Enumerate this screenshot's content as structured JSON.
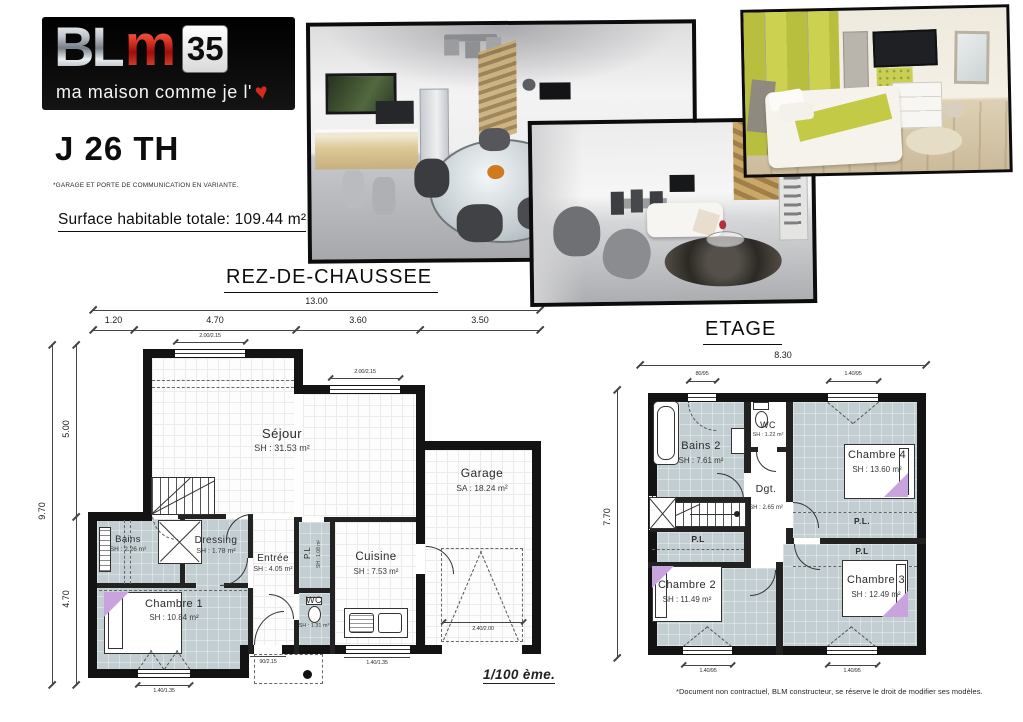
{
  "logo": {
    "bl": "BL",
    "m": "m",
    "number": "35",
    "tagline": "ma maison comme je l'",
    "heart": "♥"
  },
  "header": {
    "model": "J 26 TH",
    "variant_note": "*GARAGE ET PORTE DE COMMUNICATION EN VARIANTE.",
    "surface_total": "Surface habitable totale: 109.44 m²"
  },
  "rdc": {
    "title": "REZ-DE-CHAUSSEE",
    "dims": {
      "total_width": "13.00",
      "seg_1": "1.20",
      "seg_2": "4.70",
      "seg_3": "3.60",
      "seg_4": "3.50",
      "total_height": "9.70",
      "hseg_1": "5.00",
      "hseg_2": "4.70",
      "win_sejour_left": "2.00/2.15",
      "win_sejour_right": "2.00/2.15",
      "win_chambre": "1.40/1.35",
      "door_entree": "90/2.15",
      "win_cuisine": "1.40/1.35",
      "door_garage": "2.40/2.00"
    },
    "rooms": {
      "sejour": {
        "name": "Séjour",
        "area": "SH : 31.53 m²"
      },
      "garage": {
        "name": "Garage",
        "area": "SA : 18.24 m²"
      },
      "bains": {
        "name": "Bains",
        "area": "SH : 2.26 m²"
      },
      "dressing": {
        "name": "Dressing",
        "area": "SH : 1.78 m²"
      },
      "entree": {
        "name": "Entrée",
        "area": "SH : 4.05 m²"
      },
      "placard": {
        "name": "P.L",
        "area": "SH : 1.08 m²"
      },
      "cuisine": {
        "name": "Cuisine",
        "area": "SH : 7.53 m²"
      },
      "wc": {
        "name": "WC",
        "area": "SH : 1.31 m²"
      },
      "chambre1": {
        "name": "Chambre 1",
        "area": "SH : 10.84 m²"
      }
    }
  },
  "etage": {
    "title": "ETAGE",
    "dims": {
      "total_width": "8.30",
      "total_height": "7.70",
      "win_top_left": "80/95",
      "win_top_right": "1.40/95",
      "win_bottom_left": "1.40/95",
      "win_bottom_right": "1.40/95"
    },
    "rooms": {
      "bains2": {
        "name": "Bains 2",
        "area": "SH : 7.61 m²"
      },
      "wc": {
        "name": "WC",
        "area": "SH : 1.22 m²"
      },
      "degagement": {
        "name": "Dgt.",
        "area": "SH : 2.65 m²"
      },
      "chambre4": {
        "name": "Chambre 4",
        "area": "SH : 13.60 m²"
      },
      "chambre2": {
        "name": "Chambre 2",
        "area": "SH : 11.49 m²"
      },
      "chambre3": {
        "name": "Chambre 3",
        "area": "SH : 12.49 m²"
      },
      "placard_left": {
        "name": "P.L"
      },
      "placard_right_top": {
        "name": "P.L."
      },
      "placard_right_bottom": {
        "name": "P.L"
      }
    }
  },
  "footer": {
    "scale": "1/100 ème.",
    "disclaimer": "*Document non contractuel, BLM constructeur, se réserve le droit de modifier ses modèles."
  },
  "colors": {
    "brand_red": "#c41e1e",
    "plan_room_fill": "#c3ced2",
    "accent_purple": "#c9a3de",
    "bedroom_green": "#c5cc4a"
  }
}
